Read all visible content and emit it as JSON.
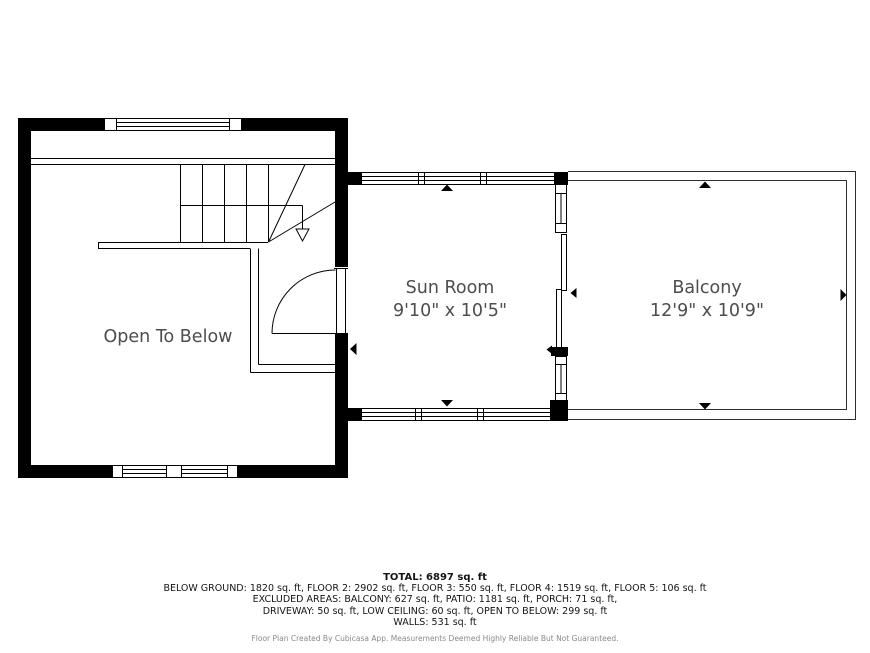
{
  "plan": {
    "rooms": {
      "open_to_below": {
        "name": "Open To Below"
      },
      "sun_room": {
        "name": "Sun Room",
        "dims": "9'10\" x 10'5\""
      },
      "balcony": {
        "name": "Balcony",
        "dims": "12'9\" x 10'9\""
      }
    }
  },
  "footer": {
    "total": "TOTAL: 6897 sq. ft",
    "floors": "BELOW GROUND: 1820 sq. ft, FLOOR 2: 2902 sq. ft, FLOOR 3: 550 sq. ft, FLOOR 4: 1519 sq. ft, FLOOR 5: 106 sq. ft",
    "excluded1": "EXCLUDED AREAS: BALCONY: 627 sq. ft, PATIO: 1181 sq. ft, PORCH: 71 sq. ft,",
    "excluded2": "DRIVEWAY: 50 sq. ft, LOW CEILING: 60 sq. ft, OPEN TO BELOW: 299 sq. ft",
    "walls": "WALLS: 531 sq. ft",
    "disclaimer": "Floor Plan Created By Cubicasa App. Measurements Deemed Highly Reliable But Not Guaranteed."
  },
  "colors": {
    "wall": "#000000",
    "line": "#2e2e2e",
    "room_label": "#4d4d4d",
    "disclaimer_text": "#8a8a8a",
    "background": "#ffffff"
  }
}
